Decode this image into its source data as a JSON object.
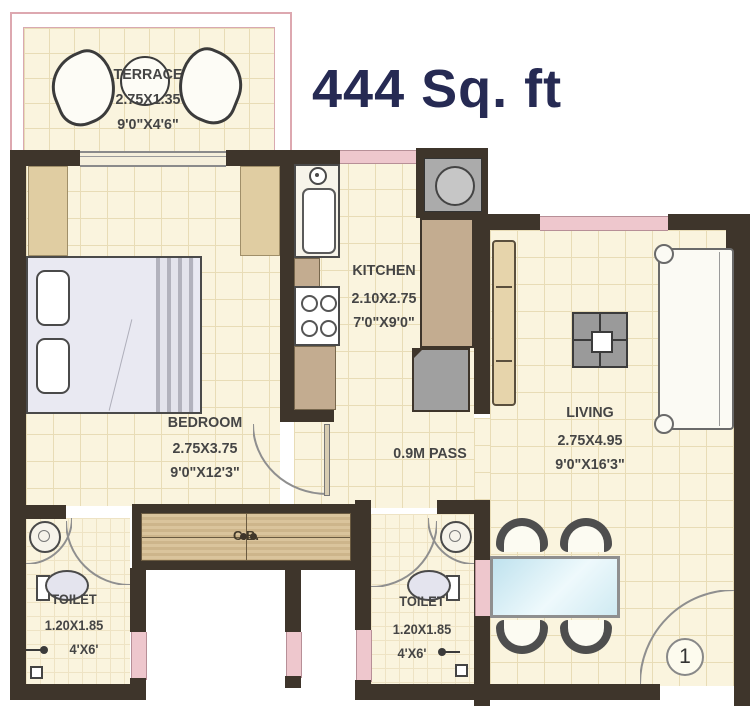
{
  "title": "444 Sq. ft",
  "rooms": {
    "terrace": {
      "name": "TERRACE",
      "size_m": "2.75X1.35",
      "size_ft": "9'0\"X4'6\""
    },
    "bedroom": {
      "name": "BEDROOM",
      "size_m": "2.75X3.75",
      "size_ft": "9'0\"X12'3\""
    },
    "kitchen": {
      "name": "KITCHEN",
      "size_m": "2.10X2.75",
      "size_ft": "7'0\"X9'0\""
    },
    "living": {
      "name": "LIVING",
      "size_m": "2.75X4.95",
      "size_ft": "9'0\"X16'3\""
    },
    "passage": {
      "name": "0.9M PASS"
    },
    "toilet_left": {
      "name": "TOILET",
      "size_m": "1.20X1.85",
      "size_ft": "4'X6'"
    },
    "toilet_right": {
      "name": "TOILET",
      "size_m": "1.20X1.85",
      "size_ft": "4'X6'"
    },
    "cupboard": {
      "name": "C.B."
    },
    "entrance": {
      "label": "1"
    }
  },
  "colors": {
    "wall": "#3e352b",
    "window_pink": "#eec7cd",
    "floor_cream": "#faf4de",
    "grid_tan": "#e8dcb6",
    "counter_tan": "#c3ac90",
    "title_navy": "#262a53",
    "label_gray": "#454545"
  }
}
